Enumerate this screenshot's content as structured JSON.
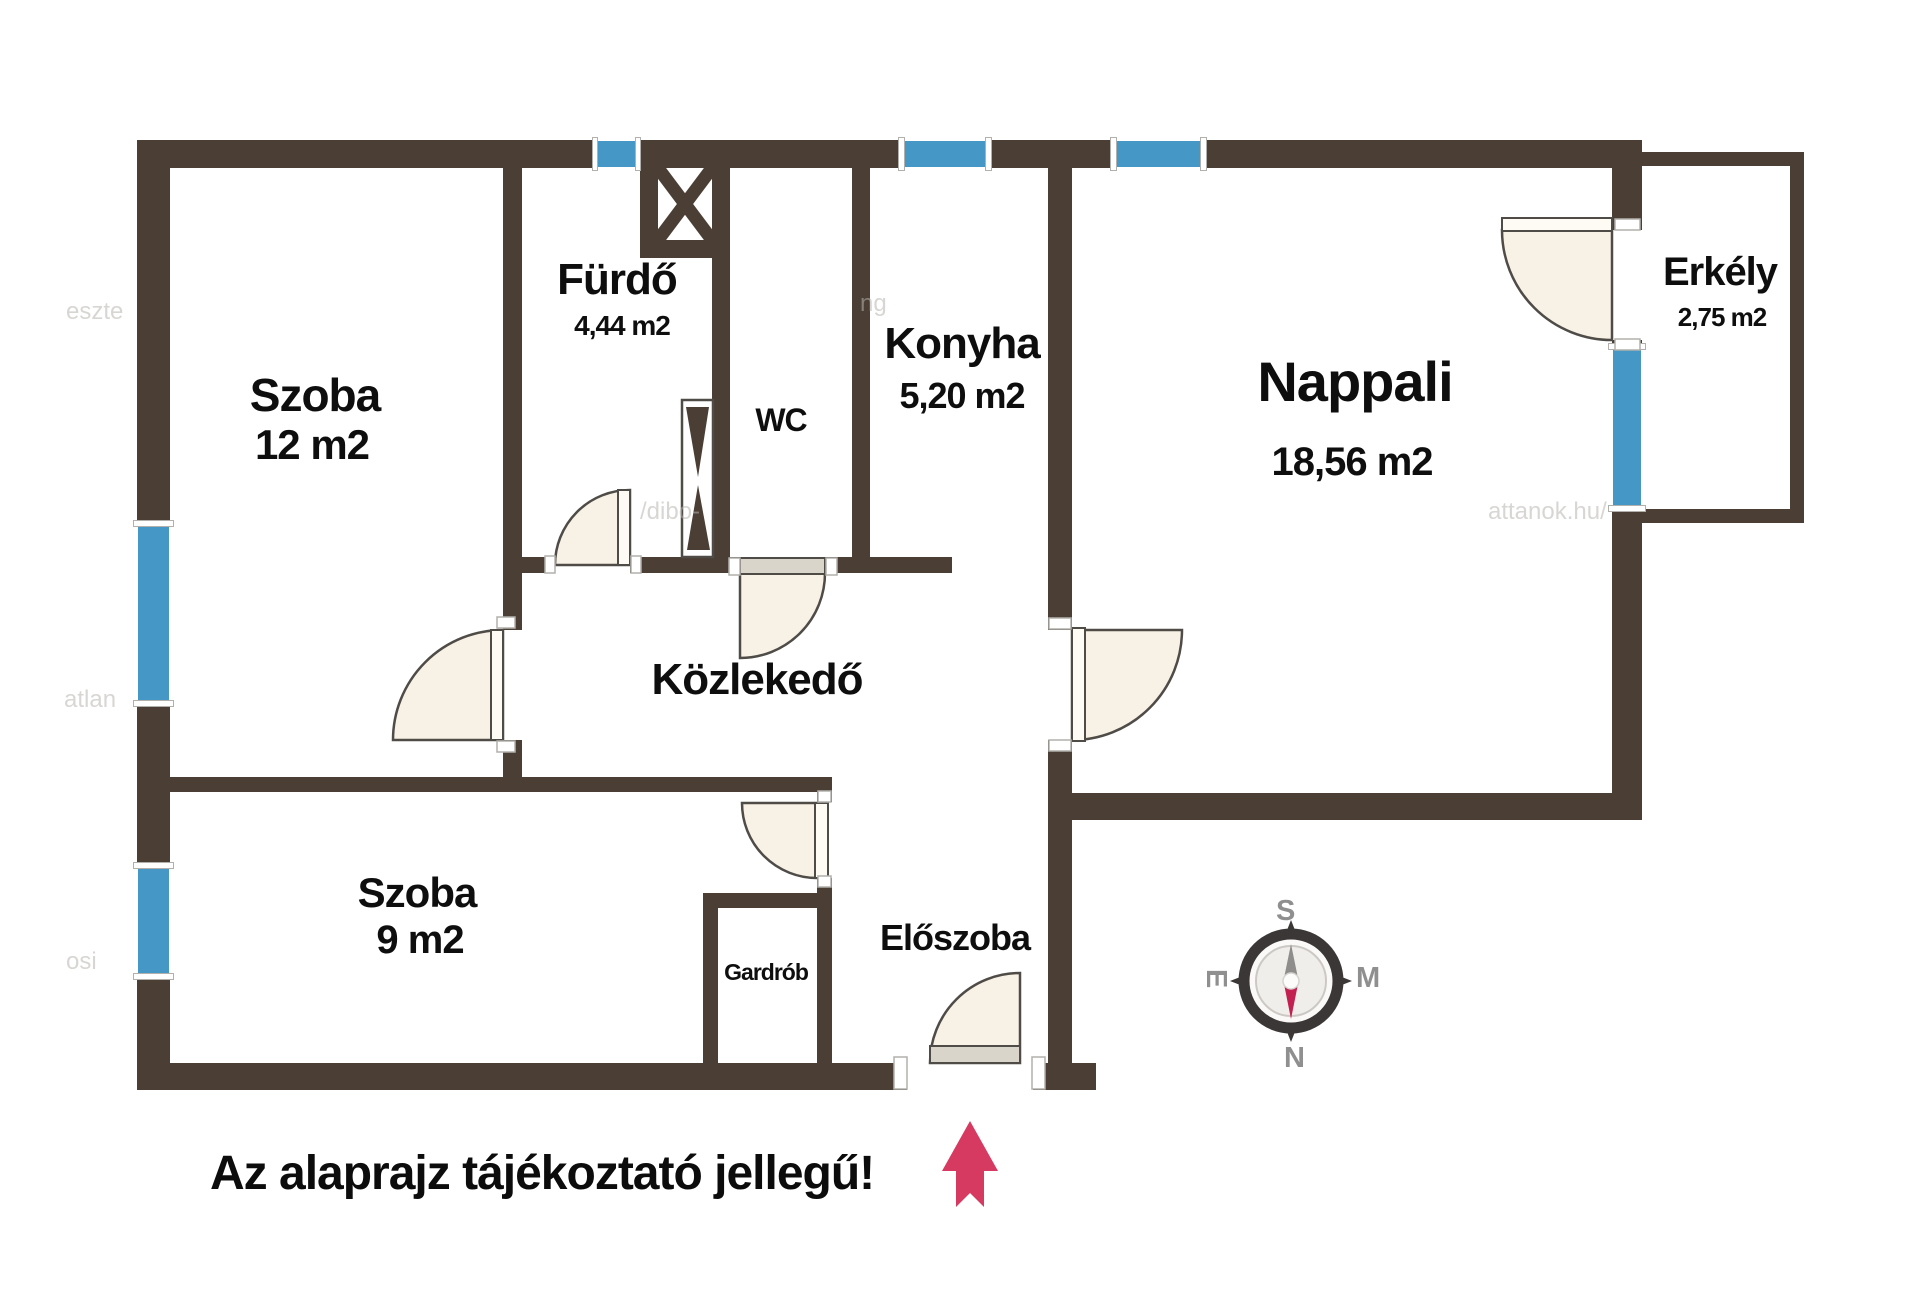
{
  "plan": {
    "disclaimer": "Az alaprajz tájékoztató jellegű!",
    "colors": {
      "wall": "#4a3e35",
      "window": "#4598c5",
      "door_fill": "#f8f2e6",
      "door_stroke": "#4f4b47",
      "door_leaf_gray": "#d9d5cb",
      "label_text": "#0e0e0e",
      "arrow": "#d63a60",
      "compass_ring": "#3b3737",
      "compass_needle_north": "#c22050",
      "compass_needle_south": "#8e8d8b",
      "compass_letters": "#8f8f8f",
      "watermark": "#b9b6b0"
    },
    "rooms": {
      "szoba12": {
        "name": "Szoba",
        "area": "12 m2"
      },
      "furdo": {
        "name": "Fürdő",
        "area": "4,44 m2"
      },
      "wc": {
        "name": "WC"
      },
      "konyha": {
        "name": "Konyha",
        "area": "5,20 m2"
      },
      "nappali": {
        "name": "Nappali",
        "area": "18,56 m2"
      },
      "erkely": {
        "name": "Erkély",
        "area": "2,75 m2"
      },
      "kozlekedo": {
        "name": "Közlekedő"
      },
      "szoba9": {
        "name": "Szoba",
        "area": "9 m2"
      },
      "gardrob": {
        "name": "Gardrób"
      },
      "eloszoba": {
        "name": "Előszoba"
      }
    },
    "compass": {
      "top": "S",
      "right": "M",
      "bottom": "N",
      "left": "E"
    },
    "watermarks": [
      "eszte",
      "/dibo-",
      "attanok.hu/",
      "atlan",
      "osi",
      "ng"
    ]
  }
}
